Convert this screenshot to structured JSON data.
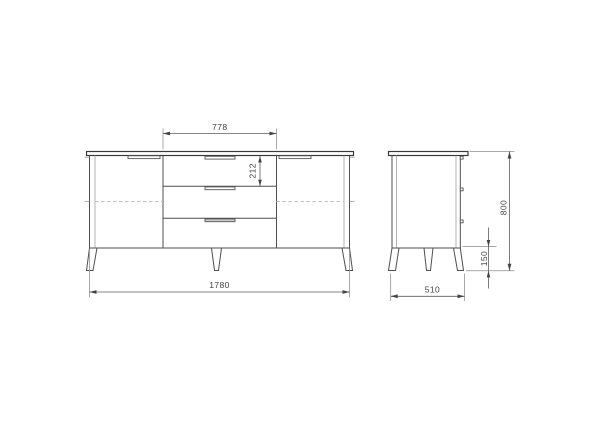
{
  "drawing": {
    "kind": "furniture-dimension-drawing",
    "subject": "sideboard with two doors, three center drawers, tapered legs",
    "views": [
      "front-elevation",
      "side-elevation"
    ]
  },
  "dimensions": {
    "drawer_section_width": "778",
    "top_drawer_height": "212",
    "overall_width": "1780",
    "depth": "510",
    "overall_height": "800",
    "leg_height": "150"
  },
  "colors": {
    "background": "#ffffff",
    "outline": "#4f4f4f",
    "dimension_line": "#5c5c5c",
    "label_text": "#3f3f3f",
    "dashed_shelf_line": "#bfbfbf",
    "filled_handle": "#c9c9c9"
  }
}
